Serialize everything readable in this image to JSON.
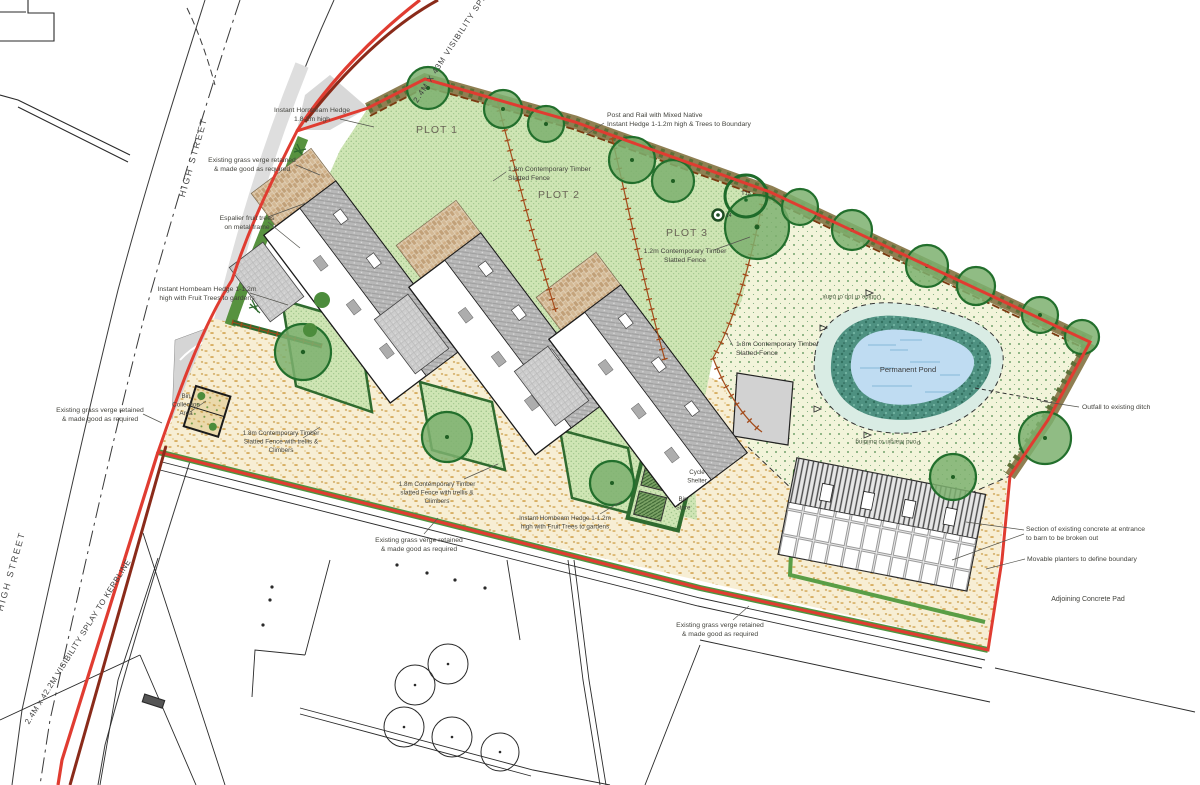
{
  "drawing_type": "residential site plan",
  "colors": {
    "boundary_red": "#e03c31",
    "splay_maroon": "#8a2b1a",
    "garden_green": "#cfe5b4",
    "paddock_green": "#f2f4da",
    "gravel_sand": "#f7eed4",
    "hedge_dark": "#2f6b2f",
    "tree_green": "#7db06e",
    "fence_brown": "#a34a1a",
    "pond_water": "#bfdcf2",
    "pond_bank": "#4e9181",
    "road_gray": "#dedede",
    "roof_gray": "#b8b8b8"
  },
  "plots": [
    "PLOT 1",
    "PLOT 2",
    "PLOT 3"
  ],
  "tree_refs": [
    "T13",
    "14"
  ],
  "annotations": [
    {
      "id": "visibility-splay-top",
      "x": 452,
      "y": 50,
      "rot": -57,
      "size": 8,
      "ls": 1,
      "color": "#3f3f3f",
      "lines": [
        "2.4M X 43M VISIBILITY SPL"
      ]
    },
    {
      "id": "instant-hornbeam-hedge-tall",
      "x": 312,
      "y": 112,
      "lines": [
        "Instant Hornbeam Hedge",
        "1.8-2m high"
      ]
    },
    {
      "id": "existing-grass-verge-1",
      "x": 252,
      "y": 162,
      "lines": [
        "Existing grass verge retained",
        "& made good as required"
      ]
    },
    {
      "id": "espalier-fruit-trees",
      "x": 247,
      "y": 220,
      "lines": [
        "Espalier fruit trees",
        "on metal frame"
      ]
    },
    {
      "id": "post-and-rail-hedge",
      "x": 607,
      "y": 117,
      "align": "start",
      "lines": [
        "Post and Rail with Mixed Native",
        "Instant Hedge 1-1.2m high & Trees to Boundary"
      ]
    },
    {
      "id": "plot-1",
      "x": 437,
      "y": 133,
      "size": 10.5,
      "ls": 1,
      "color": "#6a6557",
      "lines": [
        "PLOT 1"
      ]
    },
    {
      "id": "fence-18-plots",
      "x": 508,
      "y": 171,
      "align": "start",
      "lines": [
        "1.8m Contemporary Timber",
        "Slatted Fence"
      ]
    },
    {
      "id": "plot-2",
      "x": 559,
      "y": 198,
      "size": 10.5,
      "ls": 1,
      "color": "#6a6557",
      "lines": [
        "PLOT 2"
      ]
    },
    {
      "id": "plot-3",
      "x": 687,
      "y": 236,
      "size": 10.5,
      "ls": 1,
      "color": "#6a6557",
      "lines": [
        "PLOT 3"
      ]
    },
    {
      "id": "fence-12-plot3",
      "x": 685,
      "y": 253,
      "lines": [
        "1.2m Contemporary Timber",
        "Slatted Fence"
      ]
    },
    {
      "id": "tree-t13",
      "x": 746,
      "y": 195,
      "size": 5.5,
      "color": "#333333",
      "lines": [
        "T13"
      ]
    },
    {
      "id": "tree-14",
      "x": 726,
      "y": 217,
      "size": 5,
      "align": "start",
      "color": "#333333",
      "lines": [
        "14"
      ]
    },
    {
      "id": "fence-18-pond",
      "x": 736,
      "y": 346,
      "align": "start",
      "lines": [
        "1.8m Contemporary Timber",
        "Slatted Fence"
      ]
    },
    {
      "id": "top-of-bank",
      "x": 852,
      "y": 295,
      "rot": 180,
      "size": 6.2,
      "color": "#4f5f45",
      "lines": [
        "Outline of top of bank"
      ]
    },
    {
      "id": "permanent-pond",
      "x": 908,
      "y": 372,
      "size": 7.5,
      "color": "#3a3a3a",
      "lines": [
        "Permanent Pond"
      ]
    },
    {
      "id": "outfall",
      "x": 1082,
      "y": 409,
      "align": "start",
      "lines": [
        "Outfall to existing ditch"
      ]
    },
    {
      "id": "pond-margin",
      "x": 888,
      "y": 440,
      "rot": 180,
      "size": 6.2,
      "color": "#4f5f45",
      "lines": [
        "Pond Margin to building"
      ]
    },
    {
      "id": "hornbeam-fruit-left",
      "x": 207,
      "y": 291,
      "lines": [
        "Instant Hornbeam Hedge 1-1.2m",
        "high with Fruit Trees to gardens"
      ]
    },
    {
      "id": "existing-grass-verge-2",
      "x": 100,
      "y": 412,
      "lines": [
        "Existing grass verge retained",
        "& made good as required"
      ]
    },
    {
      "id": "bin-collection-area",
      "x": 186,
      "y": 398,
      "size": 6.3,
      "lines": [
        "Bin",
        "Collection",
        "Area"
      ]
    },
    {
      "id": "fence-trellis-left",
      "x": 281,
      "y": 435,
      "size": 6.3,
      "lines": [
        "1.8m Contemporary Timber",
        "Slatted Fence with trellis &",
        "Climbers"
      ]
    },
    {
      "id": "fence-trellis-mid",
      "x": 437,
      "y": 486,
      "size": 6.3,
      "lines": [
        "1.8m Contemporary Timber",
        "slatted Fence with trellis &",
        "Climbers"
      ]
    },
    {
      "id": "hornbeam-fruit-mid",
      "x": 565,
      "y": 520,
      "size": 6.3,
      "lines": [
        "Instant Hornbeam Hedge 1-1.2m",
        "high with Fruit Trees to gardens"
      ]
    },
    {
      "id": "cycle-shelter",
      "x": 697,
      "y": 474,
      "size": 6.2,
      "lines": [
        "Cycle",
        "Shelter"
      ]
    },
    {
      "id": "bin-store",
      "x": 683,
      "y": 501,
      "size": 6.2,
      "lines": [
        "Bin",
        "Store"
      ]
    },
    {
      "id": "existing-grass-verge-3",
      "x": 419,
      "y": 542,
      "lines": [
        "Existing grass verge retained",
        "& made good as required"
      ]
    },
    {
      "id": "existing-grass-verge-4",
      "x": 720,
      "y": 627,
      "lines": [
        "Existing grass verge retained",
        "& made good as required"
      ]
    },
    {
      "id": "concrete-broken-out",
      "x": 1026,
      "y": 531,
      "align": "start",
      "lines": [
        "Section of existing concrete at entrance",
        "to barn to be broken out"
      ]
    },
    {
      "id": "movable-planters",
      "x": 1027,
      "y": 561,
      "align": "start",
      "lines": [
        "Movable planters to define boundary"
      ]
    },
    {
      "id": "adjoining-concrete-pad",
      "x": 1088,
      "y": 601,
      "size": 7,
      "lines": [
        "Adjoining Concrete Pad"
      ]
    },
    {
      "id": "high-street-upper",
      "x": 196,
      "y": 158,
      "rot": -74,
      "size": 9,
      "ls": 2,
      "color": "#4a4a4a",
      "lines": [
        "HIGH STREET"
      ]
    },
    {
      "id": "high-street-lower",
      "x": 14,
      "y": 572,
      "rot": -74,
      "size": 9,
      "ls": 2,
      "color": "#4a4a4a",
      "lines": [
        "HIGH STREET"
      ]
    },
    {
      "id": "visibility-splay-bottom",
      "x": 80,
      "y": 643,
      "rot": -58,
      "size": 8,
      "ls": 0.5,
      "color": "#3f3f3f",
      "lines": [
        "2.4M x 42.2M VISIBILITY SPLAY TO KERBLINE"
      ]
    }
  ]
}
